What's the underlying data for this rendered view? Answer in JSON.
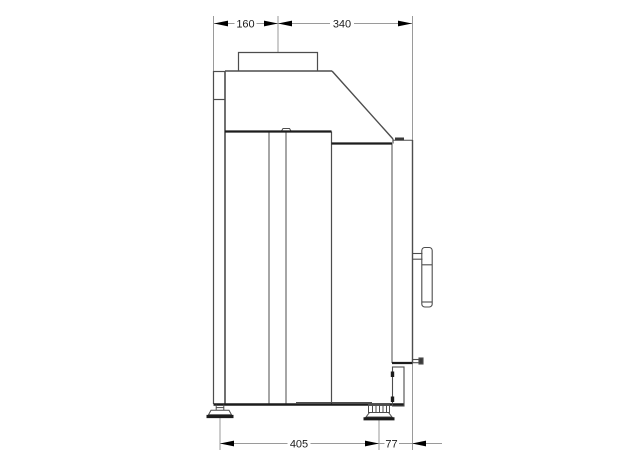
{
  "drawing": {
    "type": "technical-side-elevation",
    "subject": "boiler-side-view-with-flue-and-adjustable-feet",
    "dimensions": {
      "flue_center_from_back": "160",
      "flue_center_to_front": "340",
      "feet_spacing": "405",
      "front_foot_to_front_edge": "77"
    },
    "colors": {
      "background": "#ffffff",
      "outline": "#4d4d4d",
      "outline_heavy": "#1c1c1c",
      "outline_light": "#7a7a7a",
      "dimension_line": "#9a9a9a",
      "dimension_text": "#1c1c1c",
      "arrow": "#000000",
      "fill": "#ffffff",
      "detail_fill": "#3a3a3a"
    }
  }
}
